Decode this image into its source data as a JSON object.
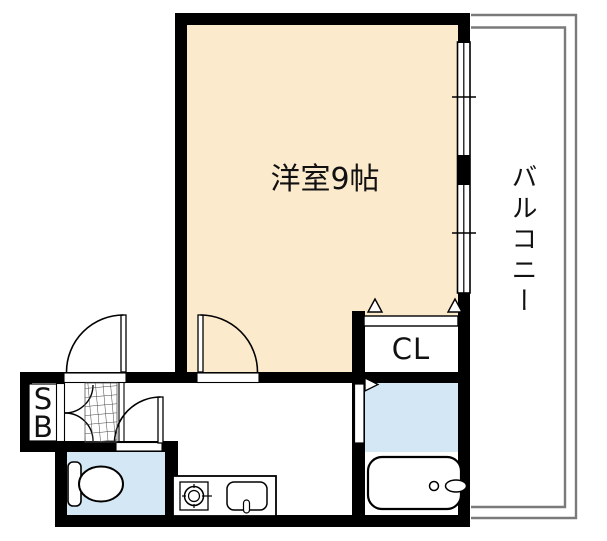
{
  "floor_plan": {
    "labels": {
      "main_room": "洋室9帖",
      "balcony": "バルコニー",
      "closet": "CL",
      "shoe_box": "SB"
    },
    "colors": {
      "wall": "#000000",
      "main_room_fill": "#FCEACD",
      "wet_area_fill": "#D3E8F4",
      "balcony_line": "#7A7A7A",
      "background": "#FFFFFF",
      "label_text": "#111111"
    },
    "fixtures": [
      "toilet",
      "bathtub",
      "kitchen-sink",
      "stove-burner",
      "entrance-tile",
      "sliding-window"
    ]
  }
}
